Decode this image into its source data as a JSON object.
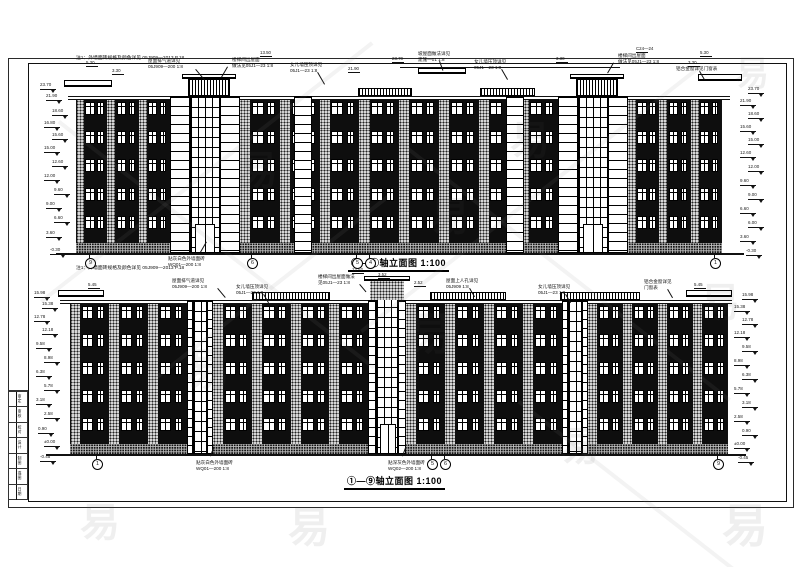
{
  "titles": {
    "top": "⑨—①轴立面图 1:100",
    "bottom": "①—⑨轴立面图 1:100"
  },
  "notes": {
    "top": "注1：外墙面砖规格及颜色详见 05J909—2013 P.18",
    "bottom": "注1：外墙面砖规格及颜色详见 05J909—2013 P.18"
  },
  "colors": {
    "line": "#1a1a1a",
    "wall_dark": "#0e0e0e",
    "speckle_base": "#d6d6d6",
    "paper": "#ffffff"
  },
  "signature_strip": {
    "rows": [
      "审定",
      "审核",
      "校对",
      "设计",
      "制图",
      "描图",
      "日期"
    ]
  },
  "annotations": {
    "top_upper": [
      {
        "t": "屋面排气道详见\n05J909—200 1:8",
        "x": 148,
        "y": 58,
        "ldr": [
          196,
          69,
          50,
          14
        ]
      },
      {
        "t": "楼梯间出屋面\n做法见05J1—23 1:8",
        "x": 232,
        "y": 57,
        "ldr": [
          228,
          67,
          120,
          12
        ]
      },
      {
        "t": "女儿墙压顶详见\n05J1—23 1:8",
        "x": 290,
        "y": 62,
        "ldr": [
          318,
          72,
          60,
          14
        ]
      },
      {
        "t": "坡屋面做法详见\n建施—01 1:8",
        "x": 418,
        "y": 51,
        "ldr": [
          440,
          61,
          70,
          10
        ]
      },
      {
        "t": "女儿墙压顶详见\n05J1—23 1:8",
        "x": 474,
        "y": 59,
        "ldr": [
          502,
          69,
          60,
          12
        ]
      },
      {
        "t": "楼梯间出屋面\n做法见05J1—23 1:8",
        "x": 618,
        "y": 53,
        "ldr": [
          614,
          63,
          120,
          12
        ]
      },
      {
        "t": "铝合金窗详见门窗表",
        "x": 676,
        "y": 66,
        "ldr": [
          700,
          71,
          60,
          10
        ]
      }
    ],
    "top_lower": [
      {
        "t": "贴灰白色外墙面砖\nWQ01—200 1:8",
        "x": 168,
        "y": 256,
        "ldr": [
          200,
          252,
          -60,
          12
        ]
      }
    ],
    "bottom_upper": [
      {
        "t": "屋面排气道详见\n05J909—200 1:8",
        "x": 172,
        "y": 278,
        "ldr": [
          218,
          288,
          50,
          12
        ]
      },
      {
        "t": "女儿墙压顶详见\n05J1—23 1:8",
        "x": 236,
        "y": 284,
        "ldr": [
          264,
          294,
          60,
          10
        ]
      },
      {
        "t": "楼梯间出屋面做法\n见05J1—23 1:8",
        "x": 318,
        "y": 274,
        "ldr": [
          360,
          284,
          50,
          10
        ]
      },
      {
        "t": "屋面上人孔详见\n05J909 1:8",
        "x": 446,
        "y": 278,
        "ldr": [
          470,
          288,
          60,
          10
        ]
      },
      {
        "t": "女儿墙压顶详见\n05J1—23 1:8",
        "x": 538,
        "y": 284,
        "ldr": [
          566,
          294,
          60,
          10
        ]
      },
      {
        "t": "铝合金窗详见\n门窗表",
        "x": 644,
        "y": 279,
        "ldr": [
          668,
          289,
          60,
          10
        ]
      }
    ],
    "bottom_lower": [
      {
        "t": "贴灰白色外墙面砖\nWQ01—200 1:8",
        "x": 196,
        "y": 460,
        "ldr": [
          210,
          456,
          -70,
          10
        ]
      },
      {
        "t": "贴深灰色外墙面砖\nWQ02—200 1:8",
        "x": 388,
        "y": 460,
        "ldr": [
          402,
          456,
          -70,
          10
        ]
      }
    ]
  },
  "dims": {
    "top": [
      {
        "v": "5.30",
        "x": 86,
        "y": 61
      },
      {
        "v": "3.30",
        "x": 112,
        "y": 69
      },
      {
        "v": "13.50",
        "x": 260,
        "y": 51
      },
      {
        "v": "23.70",
        "x": 392,
        "y": 57
      },
      {
        "v": "21.90",
        "x": 348,
        "y": 67
      },
      {
        "v": "3.30",
        "x": 556,
        "y": 57
      },
      {
        "v": "C24—24",
        "x": 636,
        "y": 47
      },
      {
        "v": "5.30",
        "x": 700,
        "y": 51
      },
      {
        "v": "3.30",
        "x": 688,
        "y": 61
      }
    ],
    "bottom": [
      {
        "v": "12.52",
        "x": 352,
        "y": 268
      },
      {
        "v": "3.52",
        "x": 378,
        "y": 273
      },
      {
        "v": "2.52",
        "x": 414,
        "y": 281
      },
      {
        "v": "5.45",
        "x": 88,
        "y": 283
      },
      {
        "v": "5.45",
        "x": 694,
        "y": 283
      }
    ]
  },
  "levels": {
    "top_left": [
      {
        "v": "23.70",
        "x": 40,
        "y": 84
      },
      {
        "v": "21.90",
        "x": 46,
        "y": 95
      },
      {
        "v": "18.60",
        "x": 52,
        "y": 110
      },
      {
        "v": "16.80",
        "x": 44,
        "y": 122
      },
      {
        "v": "15.60",
        "x": 52,
        "y": 134
      },
      {
        "v": "15.00",
        "x": 44,
        "y": 147
      },
      {
        "v": "12.60",
        "x": 52,
        "y": 161
      },
      {
        "v": "12.00",
        "x": 44,
        "y": 175
      },
      {
        "v": "9.60",
        "x": 54,
        "y": 189
      },
      {
        "v": "9.00",
        "x": 46,
        "y": 203
      },
      {
        "v": "6.60",
        "x": 54,
        "y": 217
      },
      {
        "v": "3.60",
        "x": 46,
        "y": 232
      },
      {
        "v": "-0.30",
        "x": 50,
        "y": 249
      }
    ],
    "top_right": [
      {
        "v": "23.70",
        "x": 748,
        "y": 88
      },
      {
        "v": "21.90",
        "x": 740,
        "y": 100
      },
      {
        "v": "18.60",
        "x": 748,
        "y": 113
      },
      {
        "v": "15.60",
        "x": 740,
        "y": 126
      },
      {
        "v": "15.00",
        "x": 748,
        "y": 139
      },
      {
        "v": "12.60",
        "x": 740,
        "y": 152
      },
      {
        "v": "12.00",
        "x": 748,
        "y": 166
      },
      {
        "v": "9.60",
        "x": 740,
        "y": 180
      },
      {
        "v": "9.00",
        "x": 748,
        "y": 194
      },
      {
        "v": "6.60",
        "x": 740,
        "y": 208
      },
      {
        "v": "6.00",
        "x": 748,
        "y": 222
      },
      {
        "v": "3.60",
        "x": 740,
        "y": 236
      },
      {
        "v": "-0.30",
        "x": 746,
        "y": 250
      }
    ],
    "bottom_left": [
      {
        "v": "15.98",
        "x": 34,
        "y": 292
      },
      {
        "v": "15.38",
        "x": 42,
        "y": 303
      },
      {
        "v": "12.78",
        "x": 34,
        "y": 316
      },
      {
        "v": "12.18",
        "x": 42,
        "y": 329
      },
      {
        "v": "9.58",
        "x": 36,
        "y": 343
      },
      {
        "v": "8.98",
        "x": 44,
        "y": 357
      },
      {
        "v": "6.38",
        "x": 36,
        "y": 371
      },
      {
        "v": "5.78",
        "x": 44,
        "y": 385
      },
      {
        "v": "3.18",
        "x": 36,
        "y": 399
      },
      {
        "v": "2.58",
        "x": 44,
        "y": 413
      },
      {
        "v": "0.90",
        "x": 38,
        "y": 428
      },
      {
        "v": "±0.00",
        "x": 44,
        "y": 441
      },
      {
        "v": "-0.45",
        "x": 40,
        "y": 456
      }
    ],
    "bottom_right": [
      {
        "v": "15.98",
        "x": 742,
        "y": 294
      },
      {
        "v": "15.38",
        "x": 734,
        "y": 306
      },
      {
        "v": "12.78",
        "x": 742,
        "y": 319
      },
      {
        "v": "12.18",
        "x": 734,
        "y": 332
      },
      {
        "v": "9.58",
        "x": 742,
        "y": 346
      },
      {
        "v": "8.98",
        "x": 734,
        "y": 360
      },
      {
        "v": "6.38",
        "x": 742,
        "y": 374
      },
      {
        "v": "5.78",
        "x": 734,
        "y": 388
      },
      {
        "v": "3.18",
        "x": 742,
        "y": 402
      },
      {
        "v": "2.58",
        "x": 734,
        "y": 416
      },
      {
        "v": "0.90",
        "x": 742,
        "y": 430
      },
      {
        "v": "±0.00",
        "x": 734,
        "y": 443
      },
      {
        "v": "-0.45",
        "x": 738,
        "y": 457
      }
    ]
  },
  "axes": {
    "top": {
      "y": 258,
      "ground": 253,
      "items": [
        {
          "n": "9",
          "x": 85
        },
        {
          "n": "6",
          "x": 247
        },
        {
          "n": "5",
          "x": 352
        },
        {
          "n": "4",
          "x": 365
        },
        {
          "n": "1",
          "x": 710
        }
      ]
    },
    "bottom": {
      "y": 459,
      "ground": 454,
      "items": [
        {
          "n": "1",
          "x": 92
        },
        {
          "n": "5",
          "x": 427
        },
        {
          "n": "6",
          "x": 440
        },
        {
          "n": "9",
          "x": 713
        }
      ]
    }
  },
  "facades": [
    {
      "parapet": {
        "x": 68,
        "y": 96,
        "w": 662
      },
      "floors": {
        "y": 100,
        "h": 28.6,
        "n": 5
      },
      "sections": [
        {
          "x": 76,
          "w": 94,
          "bays": 3
        },
        {
          "x": 240,
          "w": 318,
          "bays": 8
        },
        {
          "x": 628,
          "w": 94,
          "bays": 3
        }
      ],
      "towersY": [
        96,
        253
      ],
      "towers": [
        {
          "pil": [
            [
              170,
              20
            ],
            [
              220,
              20
            ]
          ],
          "glaze": [
            190,
            30
          ],
          "door": {
            "x": 195,
            "y": 224,
            "w": 20,
            "h": 29
          }
        },
        {
          "pil": [
            [
              558,
              20
            ],
            [
              608,
              20
            ]
          ],
          "glaze": [
            578,
            30
          ],
          "door": {
            "x": 583,
            "y": 224,
            "w": 20,
            "h": 29
          }
        }
      ],
      "plinth": {
        "x": 76,
        "y": 243,
        "w": 646,
        "h": 10
      },
      "ground": {
        "x": 56,
        "y": 253,
        "w": 688
      },
      "extras": [
        {
          "t": "cornice",
          "x": 182,
          "y": 74,
          "w": 54,
          "h": 5
        },
        {
          "t": "hatch",
          "x": 188,
          "y": 79,
          "w": 42,
          "h": 17
        },
        {
          "t": "cornice",
          "x": 570,
          "y": 74,
          "w": 54,
          "h": 5
        },
        {
          "t": "hatch",
          "x": 576,
          "y": 79,
          "w": 42,
          "h": 17
        },
        {
          "t": "hatch",
          "x": 358,
          "y": 88,
          "w": 54,
          "h": 8
        },
        {
          "t": "hatch",
          "x": 480,
          "y": 88,
          "w": 55,
          "h": 8
        },
        {
          "t": "coping",
          "x": 418,
          "y": 68,
          "w": 48,
          "h": 6
        },
        {
          "t": "coping",
          "x": 64,
          "y": 80,
          "w": 48,
          "h": 7
        },
        {
          "t": "coping",
          "x": 698,
          "y": 74,
          "w": 44,
          "h": 7
        },
        {
          "t": "line",
          "x": 400,
          "y": 67,
          "w": 220,
          "h": 1
        },
        {
          "t": "pilaster",
          "x": 294,
          "y": 96,
          "w": 18,
          "h": 157
        },
        {
          "t": "pilaster",
          "x": 506,
          "y": 96,
          "w": 18,
          "h": 157
        },
        {
          "t": "line",
          "x": 76,
          "y": 100,
          "w": 1,
          "h": 143
        },
        {
          "t": "line",
          "x": 721,
          "y": 100,
          "w": 1,
          "h": 143
        }
      ]
    },
    {
      "parapet": {
        "x": 60,
        "y": 300,
        "w": 672
      },
      "floors": {
        "y": 304,
        "h": 28,
        "n": 5
      },
      "sections": [
        {
          "x": 70,
          "w": 117,
          "bays": 3
        },
        {
          "x": 213,
          "w": 155,
          "bays": 4
        },
        {
          "x": 406,
          "w": 156,
          "bays": 4
        },
        {
          "x": 588,
          "w": 140,
          "bays": 4
        }
      ],
      "towersY": [
        300,
        454
      ],
      "towers": [
        {
          "pil": [
            [
              187,
              6
            ],
            [
              207,
              6
            ]
          ],
          "glaze": [
            193,
            14
          ]
        },
        {
          "pil": [
            [
              368,
              8
            ],
            [
              398,
              8
            ]
          ],
          "glaze": [
            376,
            22
          ],
          "riseY": 286,
          "door": {
            "x": 380,
            "y": 424,
            "w": 16,
            "h": 30
          }
        },
        {
          "pil": [
            [
              562,
              6
            ],
            [
              582,
              6
            ]
          ],
          "glaze": [
            568,
            14
          ]
        }
      ],
      "plinth": {
        "x": 70,
        "y": 444,
        "w": 658,
        "h": 10
      },
      "ground": {
        "x": 46,
        "y": 454,
        "w": 700
      },
      "extras": [
        {
          "t": "cornice",
          "x": 364,
          "y": 276,
          "w": 46,
          "h": 5
        },
        {
          "t": "speckle",
          "x": 370,
          "y": 281,
          "w": 34,
          "h": 19
        },
        {
          "t": "hatch",
          "x": 252,
          "y": 292,
          "w": 78,
          "h": 8
        },
        {
          "t": "hatch",
          "x": 430,
          "y": 292,
          "w": 76,
          "h": 8
        },
        {
          "t": "hatch",
          "x": 560,
          "y": 292,
          "w": 80,
          "h": 8
        },
        {
          "t": "coping",
          "x": 58,
          "y": 290,
          "w": 46,
          "h": 7
        },
        {
          "t": "coping",
          "x": 686,
          "y": 290,
          "w": 46,
          "h": 7
        },
        {
          "t": "line",
          "x": 70,
          "y": 304,
          "w": 1,
          "h": 140
        },
        {
          "t": "line",
          "x": 727,
          "y": 304,
          "w": 1,
          "h": 140
        }
      ]
    }
  ],
  "watermarks": {
    "glyph": "易",
    "items": [
      {
        "x": 735,
        "y": 46,
        "s": 34
      },
      {
        "x": 700,
        "y": 270,
        "s": 40
      },
      {
        "x": 408,
        "y": 298,
        "s": 44
      },
      {
        "x": 186,
        "y": 334,
        "s": 44
      },
      {
        "x": 510,
        "y": 108,
        "s": 40
      },
      {
        "x": 238,
        "y": 138,
        "s": 40
      },
      {
        "x": 80,
        "y": 490,
        "s": 40
      },
      {
        "x": 288,
        "y": 494,
        "s": 42
      },
      {
        "x": 722,
        "y": 490,
        "s": 46
      },
      {
        "x": 560,
        "y": 414,
        "s": 40
      },
      {
        "x": 430,
        "y": 184,
        "s": 40
      }
    ],
    "lines": [
      {
        "x": 40,
        "y": 300,
        "len": 420,
        "ang": -38
      },
      {
        "x": 360,
        "y": 330,
        "len": 430,
        "ang": -38
      },
      {
        "x": 60,
        "y": 120,
        "len": 400,
        "ang": 38
      },
      {
        "x": 400,
        "y": 140,
        "len": 420,
        "ang": 38
      },
      {
        "x": 150,
        "y": 380,
        "len": 300,
        "ang": -38
      },
      {
        "x": 520,
        "y": 400,
        "len": 280,
        "ang": 38
      }
    ]
  }
}
